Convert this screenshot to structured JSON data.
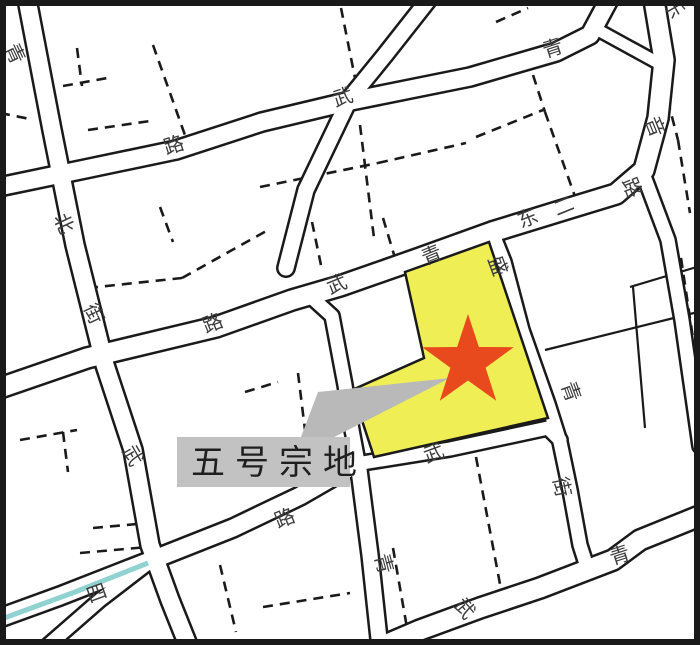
{
  "map": {
    "title_label": "五号宗地",
    "background": "#ffffff",
    "border_color": "#1a1a1a",
    "road_casing_color": "#1a1a1a",
    "road_fill_color": "#ffffff",
    "dash_color": "#1a1a1a",
    "parcel_highlight": {
      "fill": "#f0ee55",
      "stroke": "#1a1a1a",
      "points": [
        [
          405,
          272
        ],
        [
          489,
          242
        ],
        [
          548,
          418
        ],
        [
          374,
          457
        ],
        [
          352,
          390
        ],
        [
          424,
          358
        ]
      ]
    },
    "star": {
      "color": "#e8491d",
      "points": [
        [
          468,
          314
        ],
        [
          478.9,
          347
        ],
        [
          513.7,
          347.2
        ],
        [
          485.6,
          367.7
        ],
        [
          496.2,
          400.8
        ],
        [
          468,
          380.5
        ],
        [
          439.8,
          400.8
        ],
        [
          450.4,
          367.7
        ],
        [
          422.3,
          347.2
        ],
        [
          457.1,
          347
        ]
      ]
    },
    "callout": {
      "label": "五号宗地",
      "box": {
        "x": 177,
        "y": 437,
        "w": 173,
        "h": 50,
        "fill": "#c2c2c2"
      },
      "text_color": "#1f1f1f",
      "pointer": {
        "fill": "#b9b9b9",
        "points": [
          [
            450,
            378
          ],
          [
            318,
            392
          ],
          [
            293,
            458
          ]
        ]
      }
    },
    "river": {
      "color": "#8fd2d0",
      "width": 5,
      "points": [
        [
          -4,
          621
        ],
        [
          75,
          592
        ],
        [
          148,
          563
        ]
      ]
    },
    "roads": [
      {
        "name": "left-street",
        "width": 22,
        "points": [
          [
            26,
            -6
          ],
          [
            52,
            130
          ],
          [
            75,
            245
          ],
          [
            105,
            365
          ],
          [
            133,
            450
          ],
          [
            150,
            545
          ],
          [
            170,
            600
          ],
          [
            190,
            650
          ]
        ]
      },
      {
        "name": "top-street",
        "width": 22,
        "points": [
          [
            -6,
            188
          ],
          [
            90,
            168
          ],
          [
            176,
            150
          ],
          [
            262,
            122
          ],
          [
            346,
            102
          ],
          [
            470,
            77
          ],
          [
            556,
            52
          ],
          [
            590,
            35
          ],
          [
            612,
            -6
          ]
        ]
      },
      {
        "name": "ne-junction-spur",
        "width": 16,
        "points": [
          [
            598,
            30
          ],
          [
            660,
            64
          ]
        ]
      },
      {
        "name": "east-street",
        "width": 24,
        "points": [
          [
            -6,
            390
          ],
          [
            87,
            358
          ],
          [
            216,
            327
          ],
          [
            292,
            300
          ],
          [
            340,
            286
          ],
          [
            420,
            258
          ],
          [
            492,
            232
          ],
          [
            570,
            208
          ],
          [
            616,
            194
          ],
          [
            644,
            170
          ],
          [
            658,
            118
          ],
          [
            664,
            60
          ],
          [
            653,
            -6
          ]
        ]
      },
      {
        "name": "mid-steep-street-north",
        "width": 20,
        "points": [
          [
            433,
            -6
          ],
          [
            385,
            55
          ],
          [
            350,
            98
          ],
          [
            306,
            190
          ],
          [
            286,
            268
          ]
        ]
      },
      {
        "name": "mid-steep-street-south",
        "width": 18,
        "points": [
          [
            310,
            296
          ],
          [
            332,
            316
          ],
          [
            345,
            385
          ],
          [
            352,
            430
          ],
          [
            358,
            462
          ]
        ]
      },
      {
        "name": "south-steep-street",
        "width": 20,
        "points": [
          [
            358,
            462
          ],
          [
            370,
            555
          ],
          [
            380,
            648
          ]
        ]
      },
      {
        "name": "southwest-street",
        "width": 22,
        "points": [
          [
            -6,
            620
          ],
          [
            60,
            596
          ],
          [
            147,
            562
          ],
          [
            233,
            528
          ],
          [
            300,
            496
          ],
          [
            352,
            466
          ]
        ]
      },
      {
        "name": "parcel-south-street",
        "width": 18,
        "points": [
          [
            356,
            464
          ],
          [
            450,
            449
          ],
          [
            548,
            428
          ],
          [
            560,
            440
          ]
        ]
      },
      {
        "name": "parcel-east-street",
        "width": 18,
        "points": [
          [
            492,
            232
          ],
          [
            504,
            262
          ],
          [
            522,
            330
          ],
          [
            548,
            404
          ],
          [
            560,
            442
          ],
          [
            570,
            490
          ],
          [
            580,
            545
          ],
          [
            588,
            570
          ]
        ]
      },
      {
        "name": "southeast-street",
        "width": 24,
        "points": [
          [
            702,
            515
          ],
          [
            640,
            540
          ],
          [
            613,
            560
          ],
          [
            540,
            588
          ],
          [
            480,
            608
          ],
          [
            420,
            630
          ],
          [
            378,
            648
          ]
        ]
      },
      {
        "name": "east-border-street",
        "width": 18,
        "points": [
          [
            644,
            176
          ],
          [
            668,
            240
          ],
          [
            682,
            320
          ],
          [
            692,
            390
          ],
          [
            700,
            446
          ]
        ]
      },
      {
        "name": "sw-branch-street",
        "width": 18,
        "points": [
          [
            152,
            560
          ],
          [
            100,
            600
          ],
          [
            45,
            648
          ]
        ]
      }
    ],
    "dashed_lines": [
      [
        [
          153,
          45
        ],
        [
          186,
          138
        ]
      ],
      [
        [
          186,
          138
        ],
        [
          262,
          112
        ]
      ],
      [
        [
          341,
          8
        ],
        [
          355,
          78
        ]
      ],
      [
        [
          360,
          125
        ],
        [
          374,
          238
        ]
      ],
      [
        [
          77,
          48
        ],
        [
          82,
          86
        ]
      ],
      [
        [
          63,
          86
        ],
        [
          113,
          77
        ]
      ],
      [
        [
          88,
          130
        ],
        [
          150,
          121
        ]
      ],
      [
        [
          0,
          113
        ],
        [
          30,
          119
        ]
      ],
      [
        [
          260,
          187
        ],
        [
          378,
          163
        ]
      ],
      [
        [
          378,
          163
        ],
        [
          466,
          143
        ]
      ],
      [
        [
          476,
          137
        ],
        [
          543,
          110
        ]
      ],
      [
        [
          533,
          75
        ],
        [
          545,
          112
        ]
      ],
      [
        [
          545,
          112
        ],
        [
          578,
          205
        ]
      ],
      [
        [
          496,
          22
        ],
        [
          528,
          8
        ]
      ],
      [
        [
          88,
          288
        ],
        [
          182,
          278
        ]
      ],
      [
        [
          182,
          278
        ],
        [
          268,
          230
        ]
      ],
      [
        [
          312,
          222
        ],
        [
          322,
          270
        ]
      ],
      [
        [
          383,
          218
        ],
        [
          395,
          258
        ]
      ],
      [
        [
          160,
          207
        ],
        [
          173,
          242
        ]
      ],
      [
        [
          20,
          440
        ],
        [
          77,
          430
        ]
      ],
      [
        [
          63,
          432
        ],
        [
          68,
          472
        ]
      ],
      [
        [
          80,
          553
        ],
        [
          148,
          547
        ]
      ],
      [
        [
          93,
          528
        ],
        [
          148,
          523
        ]
      ],
      [
        [
          220,
          565
        ],
        [
          236,
          632
        ]
      ],
      [
        [
          245,
          392
        ],
        [
          278,
          382
        ]
      ],
      [
        [
          298,
          373
        ],
        [
          305,
          430
        ]
      ],
      [
        [
          263,
          607
        ],
        [
          350,
          593
        ]
      ],
      [
        [
          393,
          548
        ],
        [
          410,
          645
        ]
      ],
      [
        [
          476,
          457
        ],
        [
          503,
          600
        ]
      ],
      [
        [
          659,
          67
        ],
        [
          678,
          140
        ]
      ],
      [
        [
          678,
          140
        ],
        [
          690,
          213
        ]
      ],
      [
        [
          681,
          258
        ],
        [
          694,
          345
        ]
      ]
    ],
    "solid_lines": [
      [
        [
          545,
          350
        ],
        [
          698,
          312
        ]
      ],
      [
        [
          630,
          287
        ],
        [
          700,
          266
        ]
      ],
      [
        [
          633,
          287
        ],
        [
          645,
          428
        ]
      ],
      [
        [
          668,
          272
        ],
        [
          677,
          333
        ]
      ]
    ],
    "street_labels": [
      {
        "char": "青",
        "x": 14,
        "y": 54,
        "rot": 65
      },
      {
        "char": "路",
        "x": 174,
        "y": 146,
        "rot": -18
      },
      {
        "char": "武",
        "x": 343,
        "y": 98,
        "rot": -18
      },
      {
        "char": "青",
        "x": 553,
        "y": 49,
        "rot": -18
      },
      {
        "char": "乐",
        "x": 673,
        "y": 8,
        "rot": 60
      },
      {
        "char": "音",
        "x": 654,
        "y": 127,
        "rot": 68
      },
      {
        "char": "路",
        "x": 631,
        "y": 188,
        "rot": 68
      },
      {
        "char": "北",
        "x": 63,
        "y": 224,
        "rot": 65
      },
      {
        "char": "街",
        "x": 93,
        "y": 314,
        "rot": 65
      },
      {
        "char": "路",
        "x": 213,
        "y": 324,
        "rot": -22
      },
      {
        "char": "武",
        "x": 337,
        "y": 285,
        "rot": -22
      },
      {
        "char": "青",
        "x": 432,
        "y": 256,
        "rot": -22
      },
      {
        "char": "东",
        "x": 528,
        "y": 219,
        "rot": -22
      },
      {
        "char": "二",
        "x": 564,
        "y": 207,
        "rot": -22
      },
      {
        "char": "盛",
        "x": 497,
        "y": 266,
        "rot": 70
      },
      {
        "char": "青",
        "x": 570,
        "y": 392,
        "rot": 70
      },
      {
        "char": "街",
        "x": 561,
        "y": 487,
        "rot": 78
      },
      {
        "char": "武",
        "x": 434,
        "y": 454,
        "rot": -20
      },
      {
        "char": "路",
        "x": 285,
        "y": 519,
        "rot": -22
      },
      {
        "char": "青",
        "x": 383,
        "y": 564,
        "rot": 75
      },
      {
        "char": "四",
        "x": 97,
        "y": 594,
        "rot": -20
      },
      {
        "char": "青",
        "x": 620,
        "y": 556,
        "rot": -18
      },
      {
        "char": "武",
        "x": 464,
        "y": 609,
        "rot": 50
      },
      {
        "char": "武",
        "x": 132,
        "y": 456,
        "rot": 60
      }
    ]
  }
}
